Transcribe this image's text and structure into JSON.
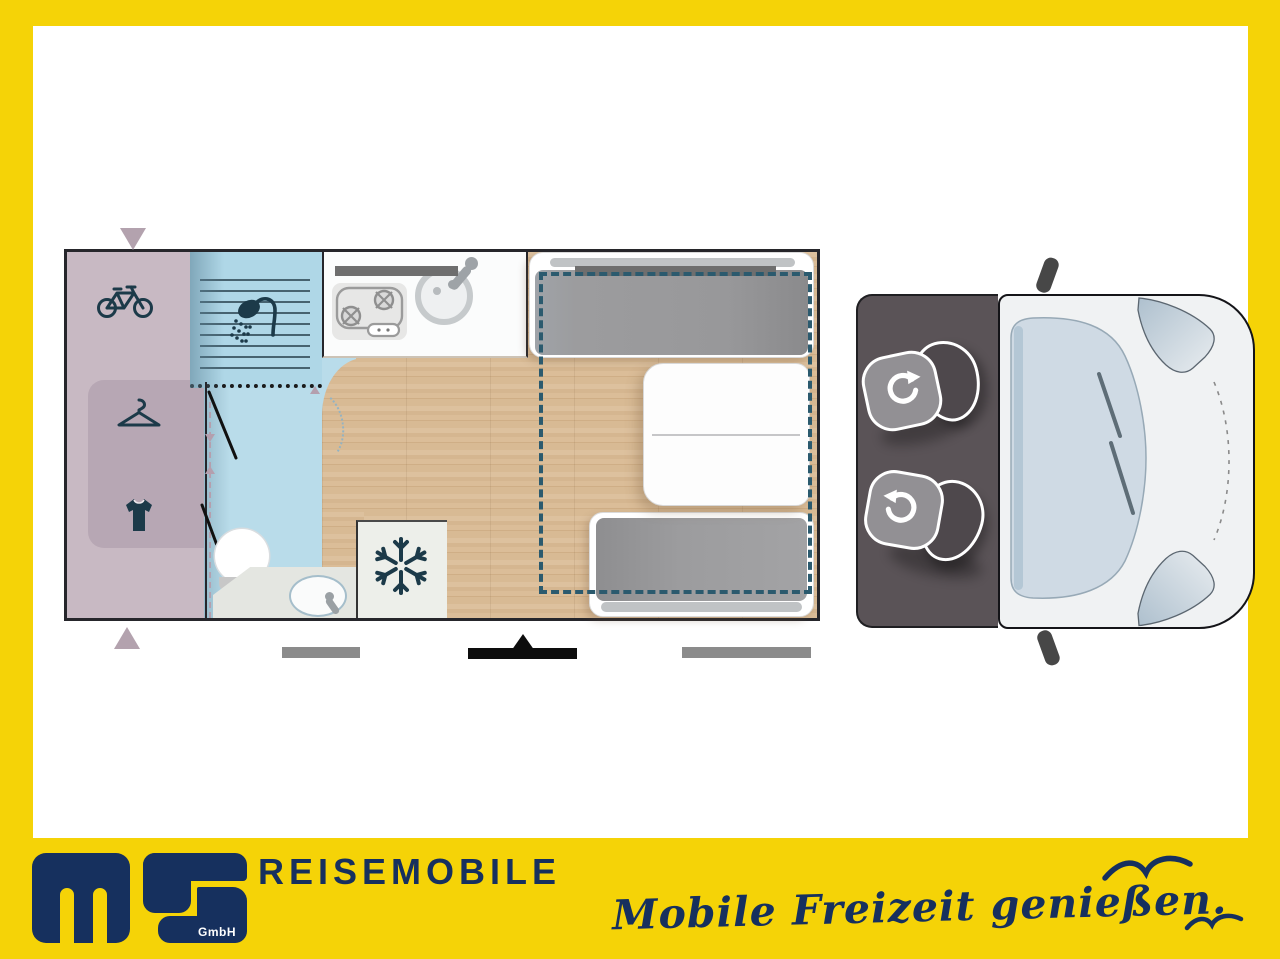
{
  "footer": {
    "logo": {
      "m": "m",
      "s": "S",
      "suffix": "GmbH"
    },
    "wordmark": "REISEMOBILE",
    "tagline": "Mobile Freizeit genießen."
  },
  "colors": {
    "frame_yellow": "#F5D307",
    "brand_navy": "#16305E",
    "garage_lavender": "#C8B9C3",
    "wardrobe_lavender": "#B7A7B4",
    "bathroom_blue": "#B9DCEA",
    "wood_floor": "#D8BA94",
    "cab_gray": "#5A5357",
    "bed_outline_teal": "#2B5A6E",
    "icon_navy": "#1C3A49"
  },
  "floorplan": {
    "features": [
      "bike-storage",
      "wardrobe",
      "shower",
      "toilet",
      "washbasin",
      "kitchen-stove",
      "kitchen-sink",
      "refrigerator",
      "dinette-table",
      "bench-seats",
      "drop-down-bed",
      "swivel-seat",
      "swivel-seat",
      "entrance-door",
      "van-cab"
    ]
  }
}
